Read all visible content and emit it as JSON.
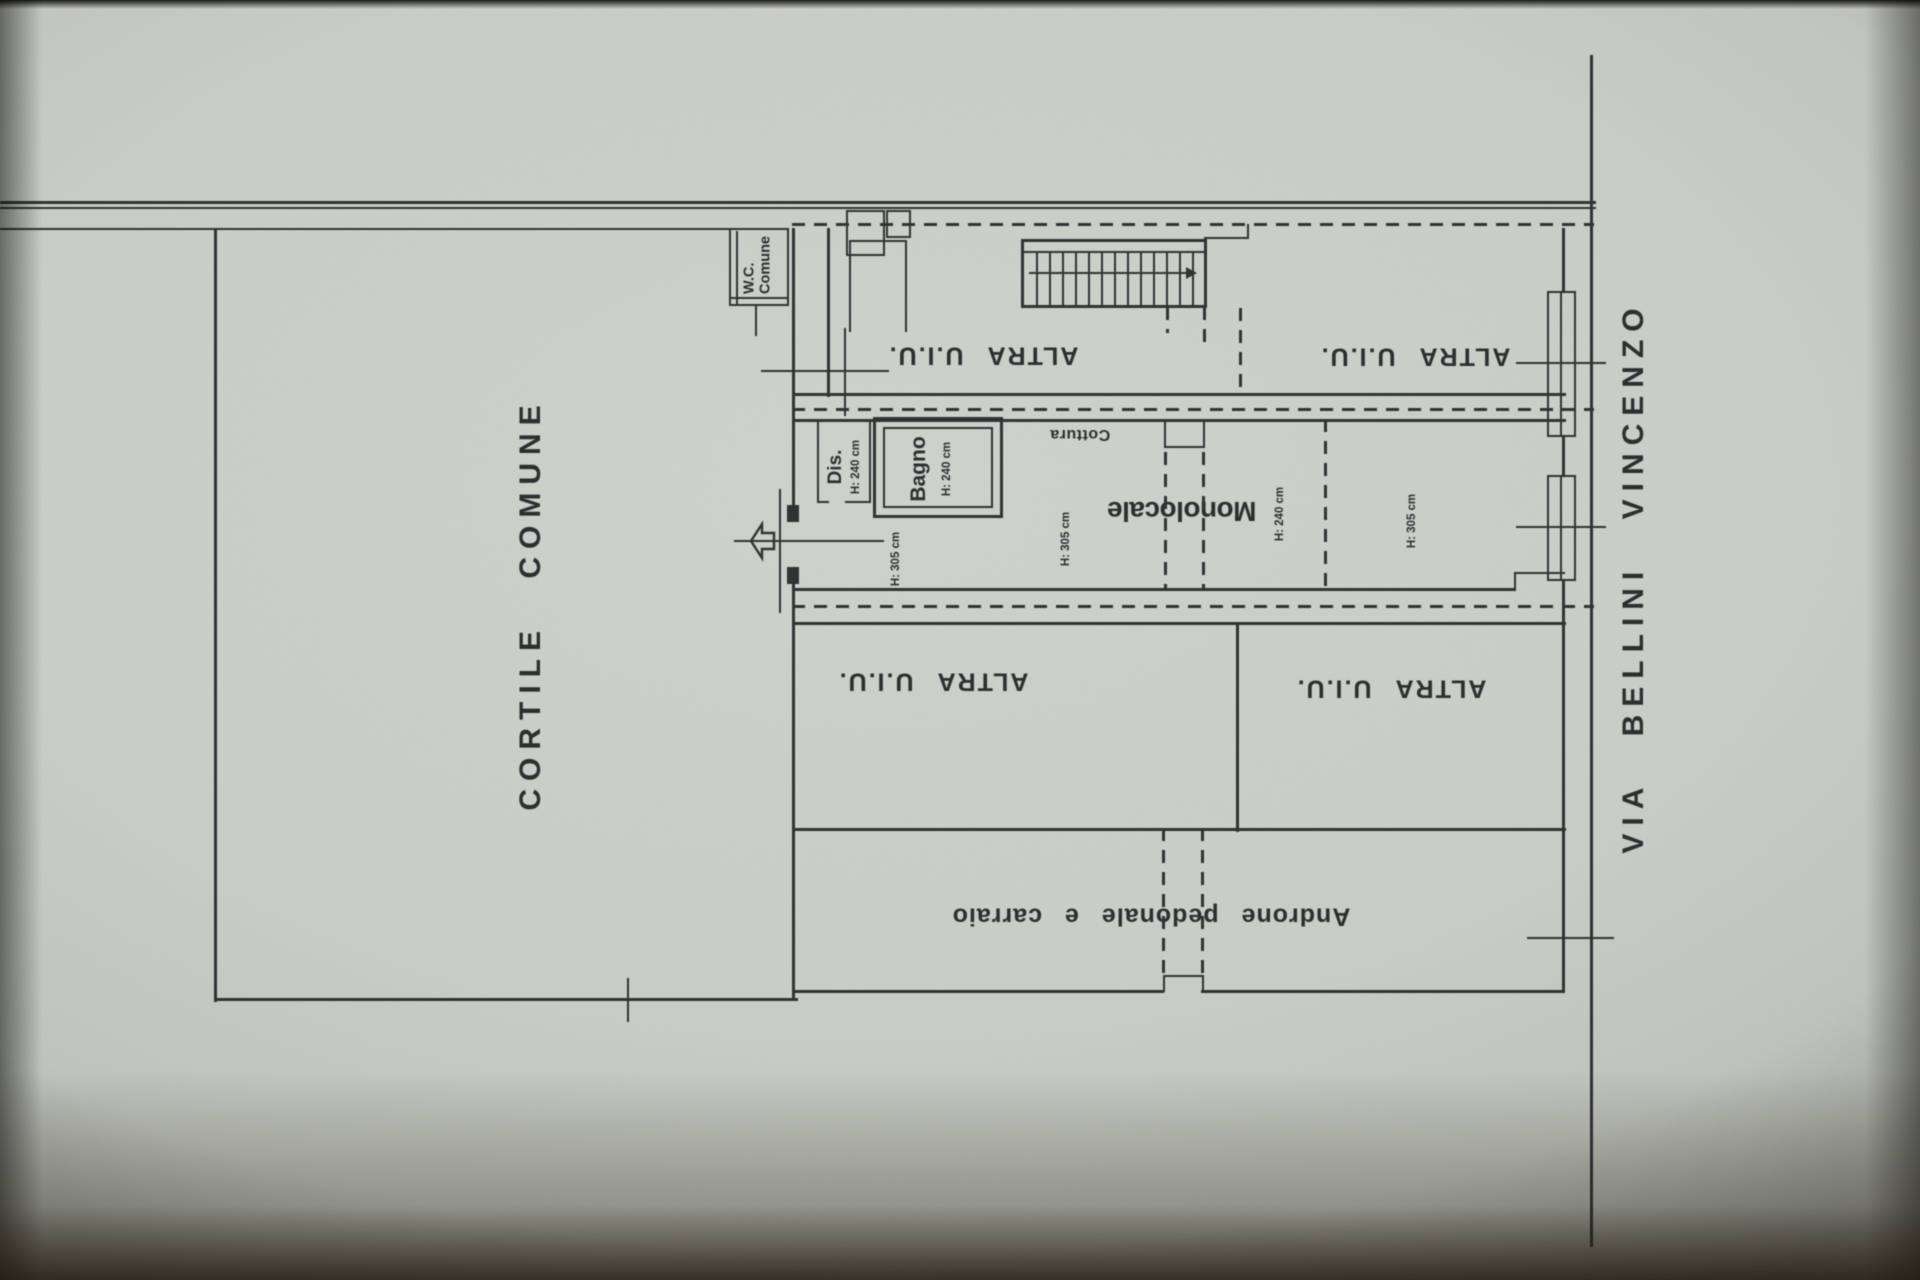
{
  "photo": {
    "paper_color": "#c7cbc3",
    "ink_color": "#2a2b2e"
  },
  "streets": {
    "via_bellini": "VIA BELLINI VINCENZO"
  },
  "courtyard": {
    "label": "CORTILE COMUNE"
  },
  "shared": {
    "wc_line1": "W.C.",
    "wc_line2": "Comune"
  },
  "units": {
    "altra_top_left": "ALTRA U.I.U.",
    "altra_top_right": "ALTRA U.I.U.",
    "altra_bottom_left": "ALTRA U.I.U.",
    "altra_bottom_right": "ALTRA U.I.U.",
    "monolocale": "Monolocale",
    "androne": "Androne pedonale e carraio"
  },
  "rooms": {
    "dis": {
      "label": "Dis.",
      "height": "H: 240 cm"
    },
    "bagno": {
      "label": "Bagno",
      "height": "H: 240 cm"
    },
    "cottura": {
      "label": "Cottura"
    },
    "corridor_height": "H: 305 cm",
    "monolocale_height": "H: 305 cm",
    "mid_room_height": "H: 240 cm",
    "right_room_height": "H: 305 cm"
  },
  "icons": {
    "entrance_arrow": "outline-left-arrow",
    "stairs_arrow": "solid-right-triangle"
  }
}
